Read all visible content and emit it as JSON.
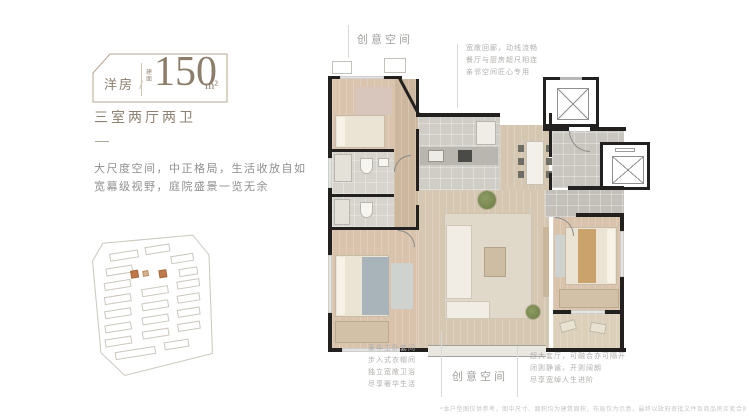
{
  "header": {
    "product_type": "洋房",
    "separator": "/",
    "area_prefix": "建面",
    "area_value": "150",
    "area_unit": "m²",
    "rooms_summary": "三室两厅两卫"
  },
  "intro": {
    "line1": "大尺度空间，中正格局，生活收放自如",
    "line2": "宽幕级视野，庭院盛景一览无余"
  },
  "callouts": {
    "top_space_label": "创意空间",
    "bottom_space_label": "创意空间",
    "entry_notes": [
      "宽敞回廊，动线流畅",
      "餐厅与厨房超尺相连",
      "亲邻空间匠心专用"
    ],
    "master_notes": [
      "豪华主卧套间",
      "步入式衣帽间",
      "独立宽敞卫浴",
      "尽享奢华生活"
    ],
    "dining_notes": [
      "超大套厅，可融合亦可隔开",
      "闭则静谧，开则阔朗",
      "尽享宽绰人生进阶"
    ]
  },
  "footer": {
    "disclaimer": "*本户型图仅供参考，图中尺寸、面积均为建筑面积，布局仅为示意，最终以政府审批文件及商品房买卖合同约定为准。"
  },
  "colors": {
    "accent_text": "#8d7e6c",
    "body_text": "#8f8f8f",
    "note_text": "#b0aeab",
    "wall": "#222120",
    "wood_floor": "#d6c7b2",
    "tile_floor": "#cac7c1",
    "bedroom_floor": "#d9c3ac",
    "site_highlight": "#c0794a"
  }
}
